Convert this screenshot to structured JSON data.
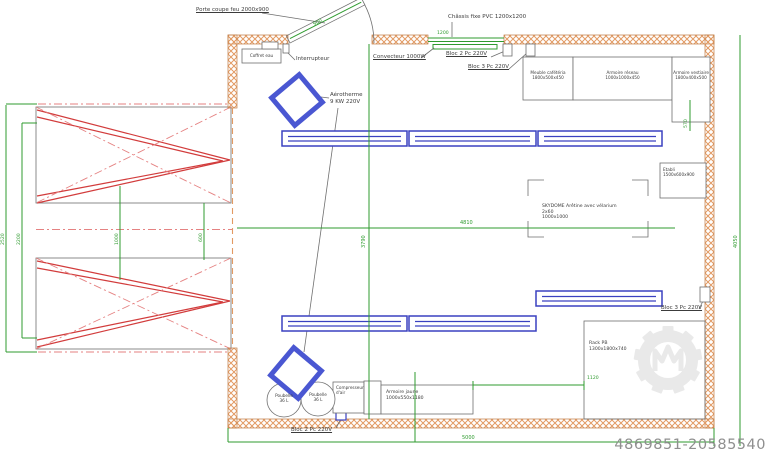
{
  "colors": {
    "wall": "#e29a63",
    "wall_edge": "#c07c45",
    "green": "#2f9b2f",
    "red": "#d23c3c",
    "red_light": "#e58282",
    "blue": "#3a41c0",
    "blue_thick": "#4a57d2",
    "gray_line": "#6f6f6f",
    "text": "#3c3c3c",
    "watermark_text": "#8f8f8f",
    "watermark_logo": "#e9e9e9"
  },
  "labels": {
    "porte_coupe_feu": "Porte coupe feu 2000x900",
    "chassis_fixe": "Châssis fixe PVC 1200x1200",
    "coffret_eau": "Coffret eau",
    "interrupteur": "Interrupteur",
    "convecteur": "Convecteur 1000W",
    "bloc2_top": "Bloc 2 Pc 220V",
    "bloc3_top": "Bloc 3 Pc 220V",
    "meuble_cafeteria": {
      "name": "Meuble cafétéria",
      "dims": "1800x500x450"
    },
    "armoire_reseau": {
      "name": "Armoire réseau",
      "dims": "1000x1000x450"
    },
    "armoire_vestiaire": {
      "name": "Armoire vestiaire",
      "dims": "1800x400x500"
    },
    "aerotherme": {
      "name": "Aérotherme",
      "dims": "9 KW 220V"
    },
    "skydome": {
      "line1": "SKYDOME Arêtine avec vélarium",
      "line2": "2x60",
      "line3": "1000x1000"
    },
    "etabli": {
      "name": "Etabli",
      "dims": "1500x600x900"
    },
    "bloc3_right": "Bloc 3 Pc 220V",
    "rack": {
      "name": "Rack PB",
      "dims": "1300x1800x740"
    },
    "poubelle1": {
      "name": "Poubelle",
      "dims": "36 L"
    },
    "poubelle2": {
      "name": "Poubelle",
      "dims": "36 L"
    },
    "compresseur": {
      "name": "Compresseur",
      "dims": "d'air"
    },
    "armoire_jaune": {
      "name": "Armoire jaune",
      "dims": "1000x550x1180"
    },
    "bloc2_bottom": "Bloc 2 Pc 220V"
  },
  "dimensions": {
    "porte": "900",
    "chassis": "1200",
    "vestiaire_offset": "570",
    "largeur_interieure": "4810",
    "hauteur_interieure": "3790",
    "hauteur_totale": "4050",
    "largeur_totale": "5000",
    "rack_offset": "1120",
    "annexe_hauteur_ext": "2520",
    "annexe_hauteur_int": "2200",
    "annexe_travee": "1000",
    "annexe_entraxe": "600"
  },
  "watermark": {
    "id": "4869851-20585540"
  }
}
